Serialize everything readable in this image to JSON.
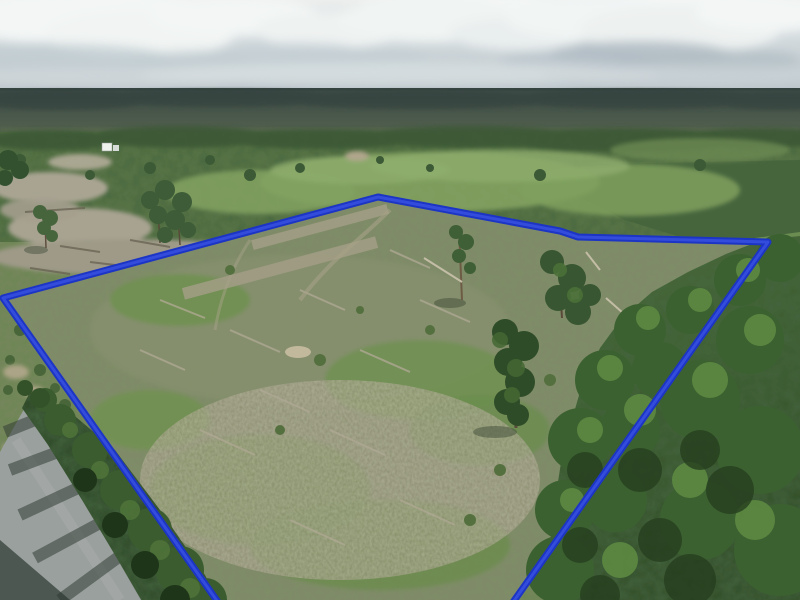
{
  "meta": {
    "kind": "aerial-drone-photograph",
    "width_px": 800,
    "height_px": 600
  },
  "scene": {
    "description": "Aerial drone photo of a recently cleared timber land parcel outlined with a bright blue property-boundary overlay, surrounded by green pine forest under a hazy cloudy sky, with a paved country road and tree shadows in the lower left corner",
    "elements": [
      "sky-with-cumulus-clouds",
      "distant-forest-horizon",
      "mid-ground-forest-and-regrowth",
      "small-white-farmhouse",
      "left-bare-dirt-clearings",
      "cleared-parcel-with-slash-debris",
      "scattered-standing-trees-in-parcel",
      "dense-green-foreground-canopy-right",
      "paved-road-lower-left-with-tree-shadows",
      "blue-property-boundary-overlay"
    ]
  },
  "boundary": {
    "label": "property-boundary-overlay",
    "points": "3,298 378,197 560,231 578,237 768,242 499,622 232,622",
    "stroke_color": "#1d35c4",
    "highlight_color": "#4059e8",
    "stroke_width_px": 7,
    "closed_on_screen": false,
    "note": "bottom vertex of parcel lies below the photo edge"
  },
  "palette": {
    "boundary_blue": "#1d35c4",
    "boundary_blue_light": "#4059e8",
    "sky_top": "#eceeed",
    "sky_horizon": "#b7c1c7",
    "cloud_white": "#f3f6f5",
    "cloud_shadow": "#aebac2",
    "far_forest": "#3c4a46",
    "mid_forest": "#5a7646",
    "regrowth_light_green": "#83a261",
    "parcel_ground": "#7e8e66",
    "slash_tan": "#a39e86",
    "dirt_gray_tan": "#a8a391",
    "canopy_dark": "#2f4c26",
    "canopy_mid": "#4c7339",
    "canopy_highlight": "#5d8a42",
    "road_gray": "#9aa09e",
    "shadow_dark": "#333f35",
    "house_white": "#eef1ee"
  }
}
